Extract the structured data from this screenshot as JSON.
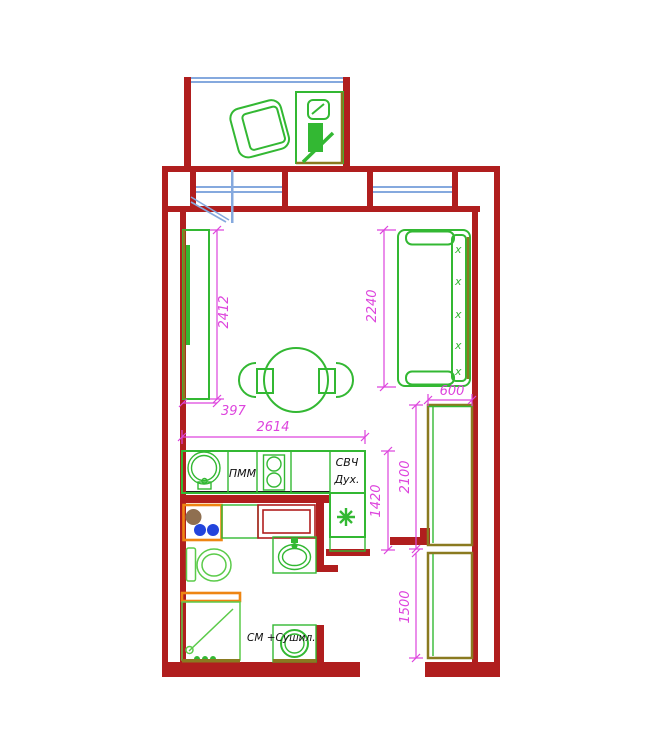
{
  "page": {
    "type": "apartment-floor-plan",
    "background": "#ffffff"
  },
  "labels": {
    "dishwasher": "ПММ",
    "microwave": "СВЧ",
    "oven": "Дух.",
    "washer_dryer": "СМ +Сушил."
  },
  "marks": {
    "sofa_back": "x"
  },
  "icons": {
    "fridge_symbol": "asterisk-icon",
    "sink": "round-sink-icon",
    "stove": "two-burner-stove-icon",
    "shower": "shower-tray-icon",
    "toilet": "toilet-icon",
    "basin": "wash-basin-icon",
    "washing_machine": "washing-machine-icon"
  },
  "dimensions": {
    "wardrobe_length": "2412",
    "wardrobe_depth": "397",
    "kitchen_width": "2614",
    "sofa_length": "2240",
    "cabinet_width": "600",
    "upper_cabinet_run": "2100",
    "lower_cabinet_run": "1500",
    "kitchen_run": "1420"
  },
  "colors": {
    "wall": "#B01E1E",
    "furniture": "#33B833",
    "furniture_light": "#5BCB4A",
    "window": "#85A9DE",
    "dimension": "#DD44DD",
    "accent_orange": "#EE8512",
    "overlap_olive": "#8A7A20",
    "meter_blue": "#2244DD",
    "meter_brown": "#8F6F50"
  }
}
